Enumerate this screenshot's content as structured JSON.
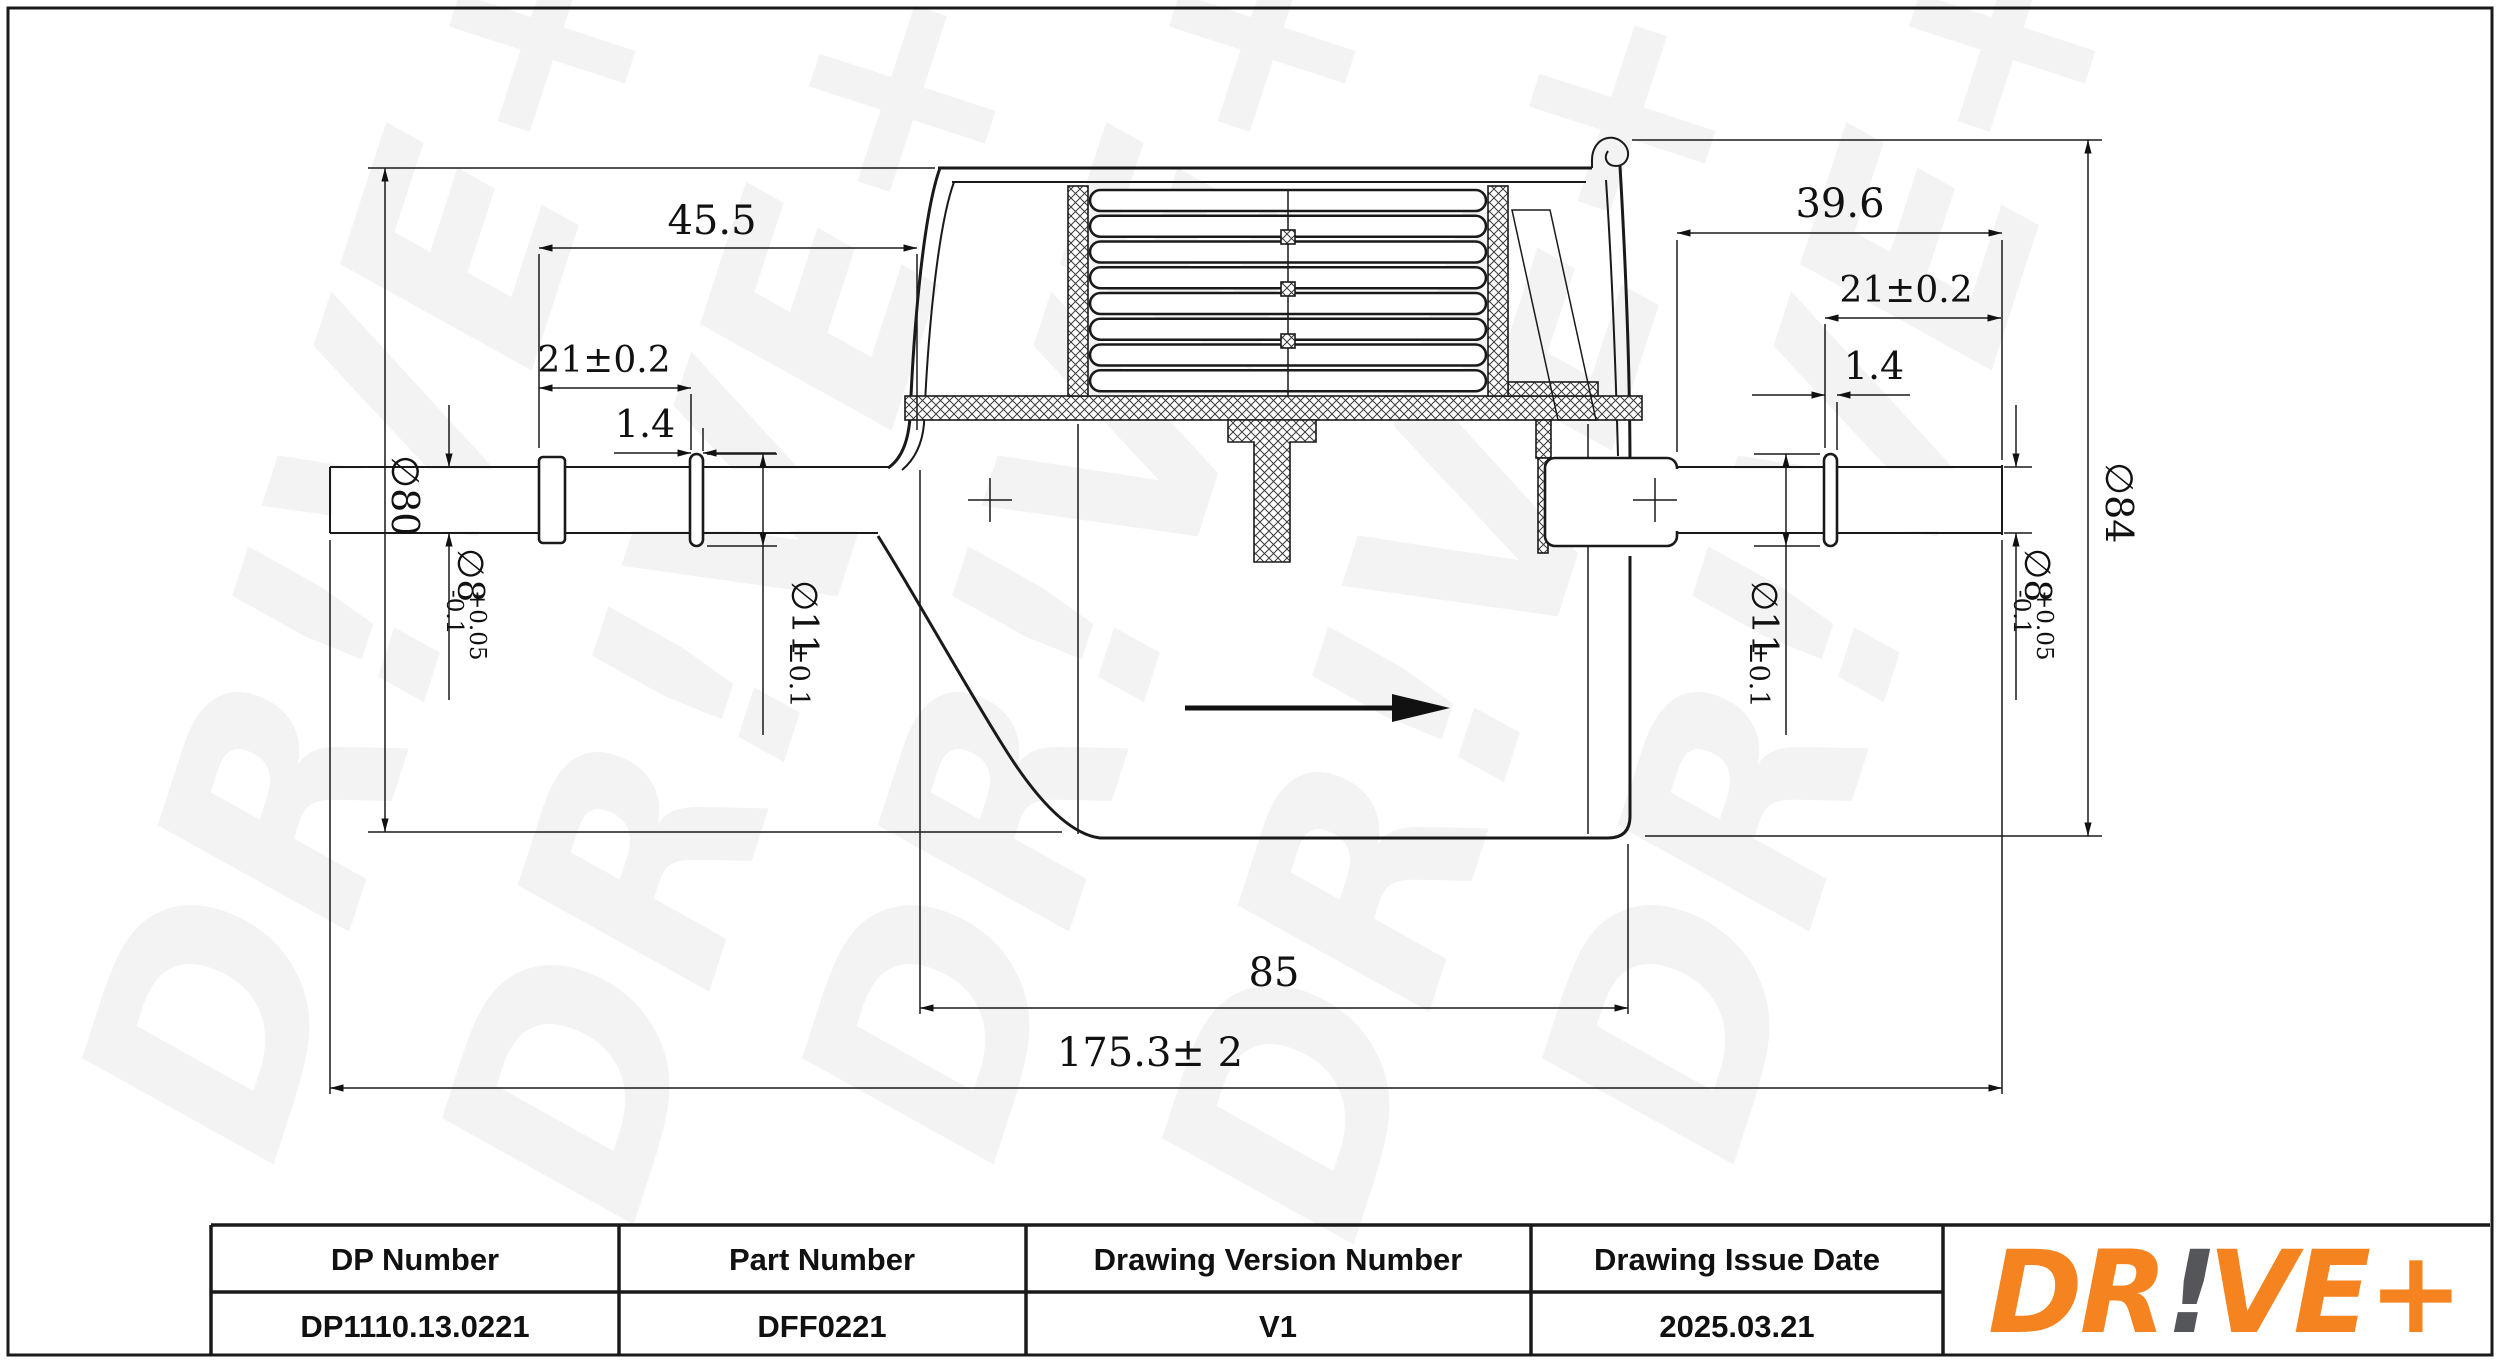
{
  "page": {
    "background": "#ffffff",
    "line_color": "#1a1a1a"
  },
  "drawing": {
    "watermark_text": "DR!VE+",
    "dimensions": {
      "overall_length": "175.3± 2",
      "body_length": "85",
      "left_end_to_body": "45.5",
      "left_tube_exposed": "21±0.2",
      "left_bead_width": "1.4",
      "right_end_to_body": "39.6",
      "right_tube_exposed": "21±0.2",
      "right_bead_width": "1.4",
      "left_body_diameter": "∅80",
      "right_body_diameter": "∅84",
      "tube_diameter": "∅8",
      "tube_tolerance_upper": "+0.05",
      "tube_tolerance_lower": "-0.1",
      "bead_diameter": "∅11",
      "bead_tolerance": "±0.1"
    }
  },
  "title_block": {
    "headers": [
      "DP Number",
      "Part Number",
      "Drawing Version Number",
      "Drawing Issue Date"
    ],
    "values": [
      "DP1110.13.0221",
      "DFF0221",
      "V1",
      "2025.03.21"
    ],
    "logo": {
      "prefix": "DR",
      "exclamation": "!",
      "suffix": "VE+",
      "color_orange": "#F5831F",
      "color_gray": "#55565A"
    }
  }
}
